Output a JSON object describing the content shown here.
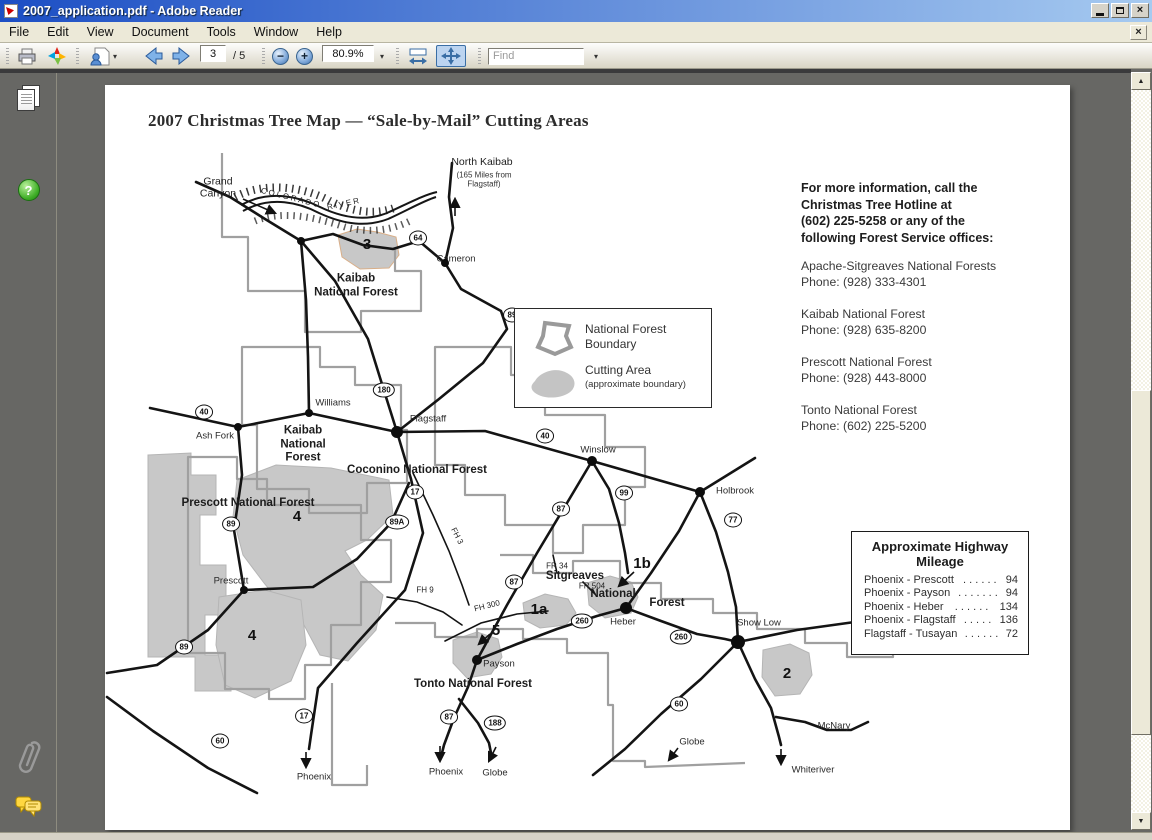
{
  "window": {
    "title": "2007_application.pdf - Adobe Reader"
  },
  "icons": {
    "caret_down": "▾",
    "close": "×",
    "doc_close": "×",
    "scroll_up": "▲",
    "scroll_down": "▼",
    "help": "?",
    "zoom_out": "−",
    "zoom_in": "+"
  },
  "menu_bar": {
    "items": [
      "File",
      "Edit",
      "View",
      "Document",
      "Tools",
      "Window",
      "Help"
    ]
  },
  "toolbar": {
    "page_current": "3",
    "page_total": "/ 5",
    "zoom_level": "80.9%",
    "find_placeholder": "Find"
  },
  "document": {
    "title": "2007 Christmas Tree Map — “Sale-by-Mail” Cutting Areas",
    "info_panel": {
      "header": "For more information, call the\nChristmas Tree Hotline at\n(602) 225-5258 or any of the\nfollowing Forest Service offices:",
      "offices": [
        {
          "name": "Apache-Sitgreaves National Forests",
          "phone": "Phone: (928) 333-4301"
        },
        {
          "name": "Kaibab National Forest",
          "phone": "Phone: (928) 635-8200"
        },
        {
          "name": "Prescott National Forest",
          "phone": "Phone: (928) 443-8000"
        },
        {
          "name": "Tonto National Forest",
          "phone": "Phone: (602) 225-5200"
        }
      ]
    },
    "legend": {
      "nf_label": "National Forest\nBoundary",
      "cut_label": "Cutting Area",
      "cut_sub": "(approximate boundary)"
    },
    "mileage": {
      "title": "Approximate Highway\nMileage",
      "rows": [
        {
          "route": "Phoenix - Prescott",
          "dots": ". . . . . .",
          "miles": "94"
        },
        {
          "route": "Phoenix - Payson",
          "dots": ". . . . . . .",
          "miles": "94"
        },
        {
          "route": "Phoenix - Heber",
          "dots": ". . . . . .",
          "miles": "134"
        },
        {
          "route": "Phoenix - Flagstaff",
          "dots": ". . . . .",
          "miles": "136"
        },
        {
          "route": "Flagstaff - Tusayan",
          "dots": ". . . . . .",
          "miles": "72"
        }
      ]
    },
    "map": {
      "labels": [
        {
          "t": "Grand\nCanyon",
          "x": 113,
          "y": 103,
          "c": "town2"
        },
        {
          "t": "COLORADO",
          "x": 186,
          "y": 113,
          "c": "small",
          "r": 14,
          "ls": 2
        },
        {
          "t": "RIVER",
          "x": 239,
          "y": 119,
          "c": "small",
          "r": -12,
          "ls": 2
        },
        {
          "t": "North Kaibab",
          "x": 377,
          "y": 77,
          "c": "town2"
        },
        {
          "t": "(165 Miles from\nFlagstaff)",
          "x": 379,
          "y": 95,
          "c": "sub"
        },
        {
          "t": "Cameron",
          "x": 351,
          "y": 174,
          "c": "town"
        },
        {
          "t": "Kaibab\nNational Forest",
          "x": 251,
          "y": 201,
          "c": "forest"
        },
        {
          "t": "Kaibab\nNational\nForest",
          "x": 198,
          "y": 360,
          "c": "forest"
        },
        {
          "t": "Coconino National Forest",
          "x": 312,
          "y": 386,
          "c": "forest"
        },
        {
          "t": "Prescott National Forest",
          "x": 143,
          "y": 419,
          "c": "forest"
        },
        {
          "t": "Sitgreaves",
          "x": 470,
          "y": 492,
          "c": "forest"
        },
        {
          "t": "National",
          "x": 508,
          "y": 510,
          "c": "forest"
        },
        {
          "t": "Forest",
          "x": 562,
          "y": 519,
          "c": "forest"
        },
        {
          "t": "Tonto National Forest",
          "x": 368,
          "y": 600,
          "c": "forest"
        },
        {
          "t": "Williams",
          "x": 228,
          "y": 318,
          "c": "town"
        },
        {
          "t": "Ash Fork",
          "x": 110,
          "y": 351,
          "c": "town"
        },
        {
          "t": "Flagstaff",
          "x": 323,
          "y": 334,
          "c": "town"
        },
        {
          "t": "Winslow",
          "x": 493,
          "y": 365,
          "c": "town"
        },
        {
          "t": "Holbrook",
          "x": 630,
          "y": 406,
          "c": "town"
        },
        {
          "t": "Heber",
          "x": 518,
          "y": 537,
          "c": "town"
        },
        {
          "t": "Show Low",
          "x": 654,
          "y": 538,
          "c": "town"
        },
        {
          "t": "Payson",
          "x": 394,
          "y": 579,
          "c": "town"
        },
        {
          "t": "Prescott",
          "x": 126,
          "y": 496,
          "c": "town"
        },
        {
          "t": "McNary",
          "x": 729,
          "y": 641,
          "c": "town"
        },
        {
          "t": "Whiteriver",
          "x": 708,
          "y": 685,
          "c": "town"
        },
        {
          "t": "Globe",
          "x": 587,
          "y": 657,
          "c": "town"
        },
        {
          "t": "Phoenix",
          "x": 341,
          "y": 687,
          "c": "town"
        },
        {
          "t": "Globe",
          "x": 390,
          "y": 688,
          "c": "town"
        },
        {
          "t": "Phoenix",
          "x": 209,
          "y": 692,
          "c": "town"
        },
        {
          "t": "FH 3",
          "x": 352,
          "y": 451,
          "c": "small",
          "r": 63
        },
        {
          "t": "FH 9",
          "x": 320,
          "y": 505,
          "c": "small"
        },
        {
          "t": "FH 300",
          "x": 382,
          "y": 521,
          "c": "small",
          "r": -14
        },
        {
          "t": "FR 34",
          "x": 452,
          "y": 481,
          "c": "small"
        },
        {
          "t": "FR 504",
          "x": 487,
          "y": 501,
          "c": "small"
        },
        {
          "t": "3",
          "x": 262,
          "y": 160,
          "c": "num"
        },
        {
          "t": "4",
          "x": 192,
          "y": 432,
          "c": "num"
        },
        {
          "t": "4",
          "x": 147,
          "y": 551,
          "c": "num"
        },
        {
          "t": "1a",
          "x": 434,
          "y": 525,
          "c": "num"
        },
        {
          "t": "1b",
          "x": 537,
          "y": 479,
          "c": "num"
        },
        {
          "t": "5",
          "x": 391,
          "y": 546,
          "c": "num"
        },
        {
          "t": "2",
          "x": 682,
          "y": 589,
          "c": "num"
        }
      ],
      "shields": [
        {
          "t": "64",
          "x": 313,
          "y": 153
        },
        {
          "t": "89",
          "x": 407,
          "y": 230
        },
        {
          "t": "40",
          "x": 99,
          "y": 327
        },
        {
          "t": "180",
          "x": 279,
          "y": 305
        },
        {
          "t": "40",
          "x": 440,
          "y": 351
        },
        {
          "t": "89",
          "x": 126,
          "y": 439
        },
        {
          "t": "89A",
          "x": 292,
          "y": 437
        },
        {
          "t": "17",
          "x": 310,
          "y": 407
        },
        {
          "t": "99",
          "x": 519,
          "y": 408
        },
        {
          "t": "87",
          "x": 456,
          "y": 424
        },
        {
          "t": "77",
          "x": 628,
          "y": 435
        },
        {
          "t": "87",
          "x": 409,
          "y": 497
        },
        {
          "t": "260",
          "x": 477,
          "y": 536
        },
        {
          "t": "260",
          "x": 576,
          "y": 552
        },
        {
          "t": "87",
          "x": 344,
          "y": 632
        },
        {
          "t": "188",
          "x": 390,
          "y": 638
        },
        {
          "t": "60",
          "x": 574,
          "y": 619
        },
        {
          "t": "17",
          "x": 199,
          "y": 631
        },
        {
          "t": "60",
          "x": 115,
          "y": 656
        },
        {
          "t": "89",
          "x": 79,
          "y": 562
        }
      ],
      "towns": [
        {
          "x": 196,
          "y": 156,
          "r": 4
        },
        {
          "x": 340,
          "y": 178,
          "r": 4
        },
        {
          "x": 133,
          "y": 342,
          "r": 4
        },
        {
          "x": 204,
          "y": 328,
          "r": 4
        },
        {
          "x": 292,
          "y": 347,
          "r": 6
        },
        {
          "x": 487,
          "y": 376,
          "r": 5
        },
        {
          "x": 595,
          "y": 407,
          "r": 5
        },
        {
          "x": 521,
          "y": 523,
          "r": 6
        },
        {
          "x": 633,
          "y": 557,
          "r": 7
        },
        {
          "x": 372,
          "y": 575,
          "r": 5
        },
        {
          "x": 139,
          "y": 505,
          "r": 4
        }
      ]
    }
  }
}
